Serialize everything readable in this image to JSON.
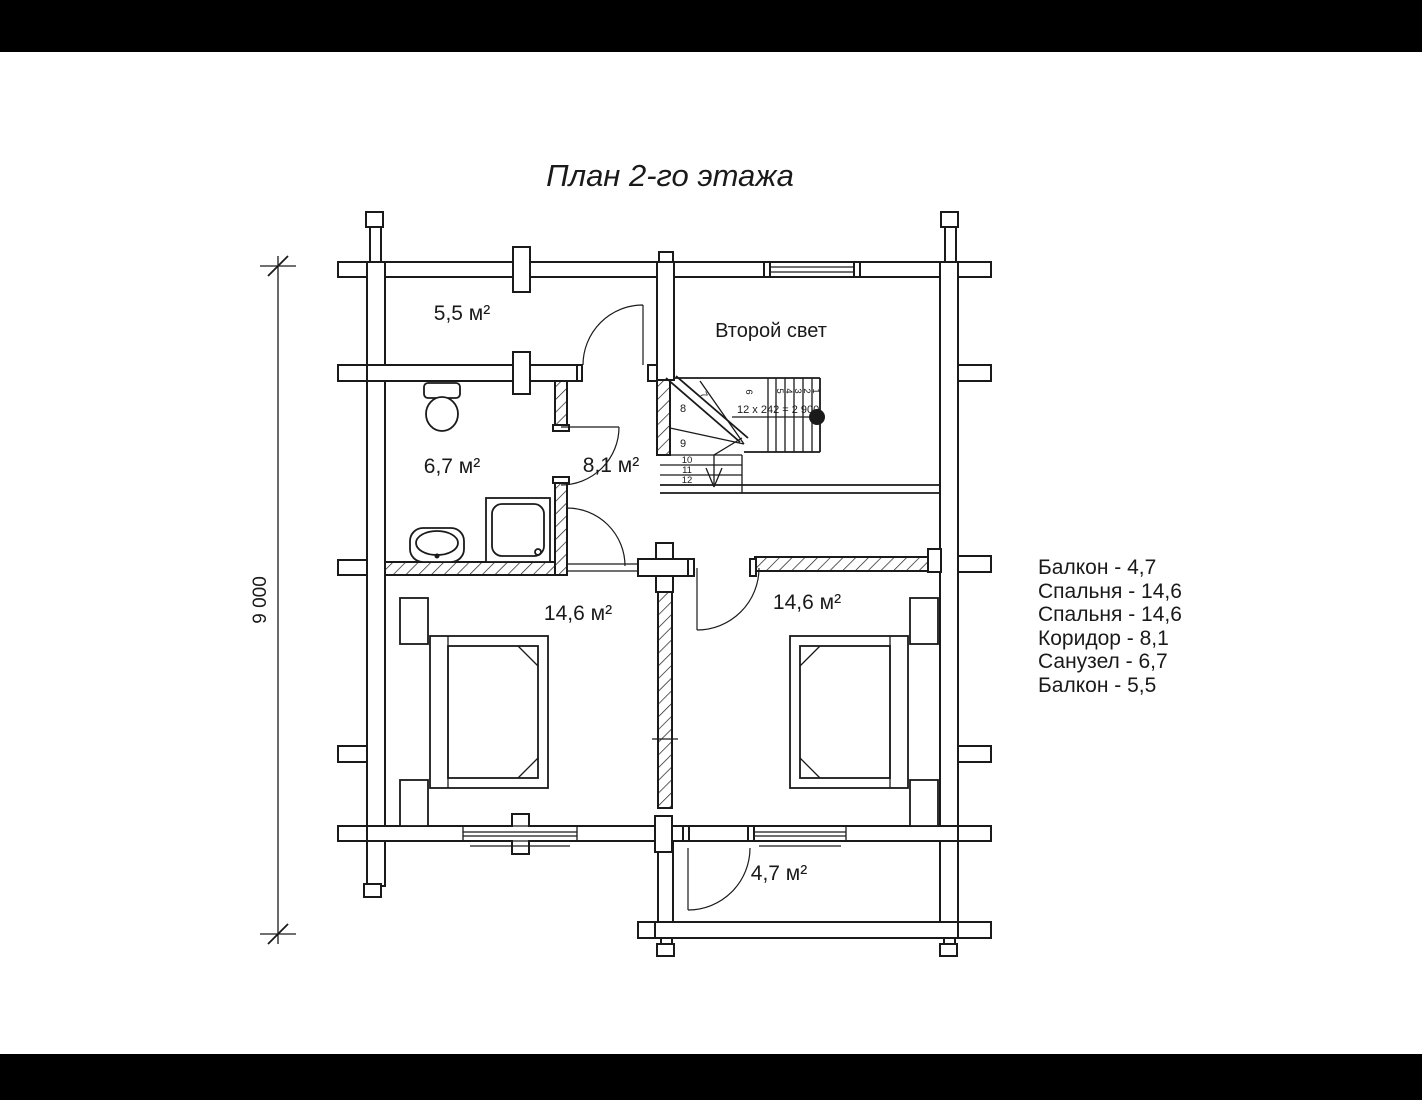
{
  "title": "План 2-го этажа",
  "dimension": {
    "value": "9 000"
  },
  "rooms": {
    "balcony_top": "5,5 м²",
    "second_light": "Второй свет",
    "bathroom": "6,7 м²",
    "corridor": "8,1 м²",
    "bedroom_left": "14,6 м²",
    "bedroom_right": "14,6 м²",
    "balcony_bottom": "4,7 м²"
  },
  "stairs": {
    "formula": "12 x 242 = 2 900",
    "steps": [
      "1",
      "2",
      "3",
      "4",
      "5",
      "6",
      "7",
      "8",
      "9",
      "10",
      "11",
      "12"
    ]
  },
  "legend": {
    "items": [
      "Балкон - 4,7",
      "Спальня - 14,6",
      "Спальня - 14,6",
      "Коридор - 8,1",
      "Санузел - 6,7",
      "Балкон - 5,5"
    ]
  },
  "colors": {
    "line": "#1a1a1a",
    "background": "#ffffff",
    "letterbox": "#000000"
  }
}
